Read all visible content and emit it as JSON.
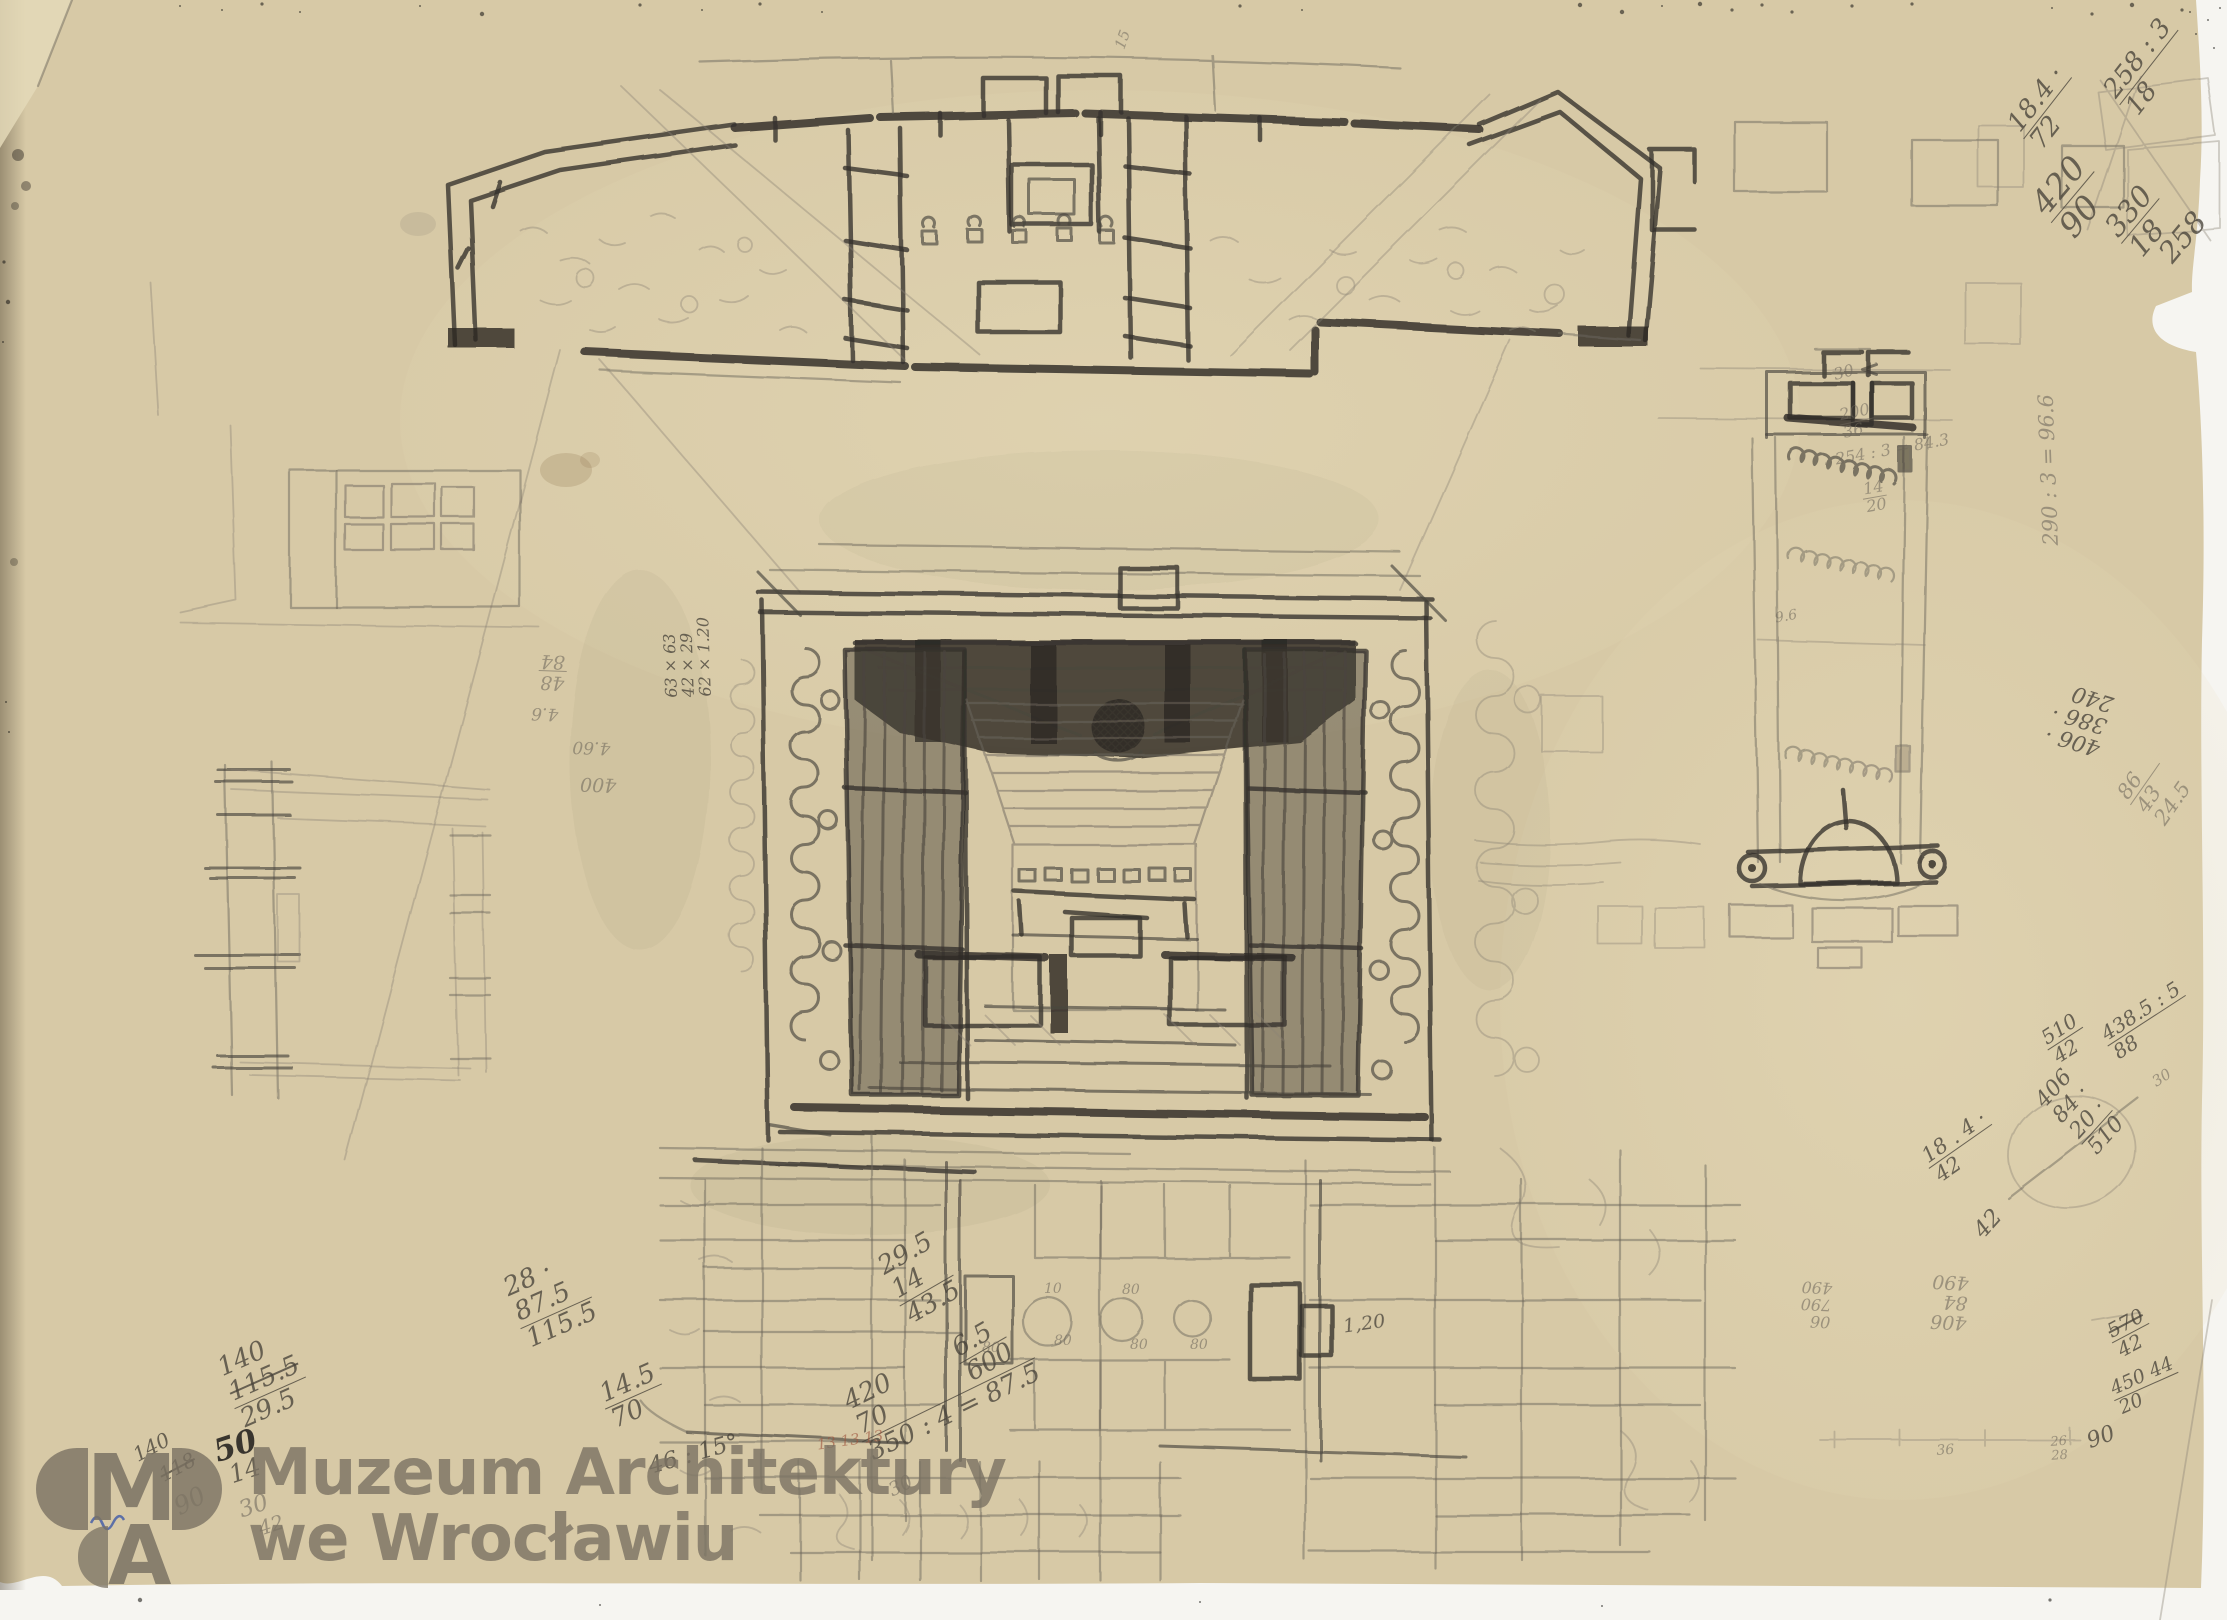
{
  "watermark": {
    "monogram_m": "M",
    "monogram_a": "A",
    "line1": "Muzeum Architektury",
    "line2": "we Wrocławiu"
  },
  "colors": {
    "paper": "#d7c9a6",
    "paper_light": "#e3d7b6",
    "paper_shadow": "#b9ab88",
    "backdrop": "#f6f5f1",
    "pencil_dark": "#2f2c28",
    "pencil_mid": "#5a544b",
    "pencil_light": "#8b8376",
    "red_pencil": "#9c543e",
    "logo_gray": "#7a7263",
    "blue_ink": "#3f5aa8"
  },
  "annotations": {
    "items": [
      {
        "t": [
          "18.4 ·",
          "72"
        ],
        "x": 2002,
        "y": 122,
        "r": -52,
        "s": 26,
        "c": "mid",
        "ul": 0
      },
      {
        "t": [
          "258 : 3",
          "18"
        ],
        "x": 2098,
        "y": 88,
        "r": -52,
        "s": 26,
        "c": "mid",
        "ul": 0
      },
      {
        "t": [
          "420",
          "90"
        ],
        "x": 2024,
        "y": 200,
        "r": -50,
        "s": 33,
        "c": "mid",
        "ul": 0
      },
      {
        "t": [
          "330",
          "18"
        ],
        "x": 2098,
        "y": 224,
        "r": -50,
        "s": 29,
        "c": "mid",
        "ul": 0
      },
      {
        "t": [
          "258"
        ],
        "x": 2152,
        "y": 250,
        "r": -50,
        "s": 29,
        "c": "mid"
      },
      {
        "t": [
          "30"
        ],
        "x": 1830,
        "y": 368,
        "r": -15,
        "s": 16,
        "c": "light"
      },
      {
        "t": [
          "200",
          "36"
        ],
        "x": 1836,
        "y": 408,
        "r": -12,
        "s": 16,
        "c": "light",
        "ul": 0
      },
      {
        "t": [
          "254 : 3 = 84.3"
        ],
        "x": 1832,
        "y": 452,
        "r": -10,
        "s": 16,
        "c": "light"
      },
      {
        "t": [
          "14",
          "20"
        ],
        "x": 1860,
        "y": 482,
        "r": -10,
        "s": 16,
        "c": "light",
        "ul": 0
      },
      {
        "t": [
          "290 : 3 = 96.6"
        ],
        "x": 2040,
        "y": 548,
        "r": -92,
        "s": 21,
        "c": "light"
      },
      {
        "t": [
          "9.6"
        ],
        "x": 1772,
        "y": 612,
        "r": -10,
        "s": 14,
        "c": "light"
      },
      {
        "t": [
          "406 ·",
          "386 ·",
          "240"
        ],
        "x": 2098,
        "y": 760,
        "r": 197,
        "s": 22,
        "c": "mid"
      },
      {
        "t": [
          "86",
          "43",
          "24.5"
        ],
        "x": 2112,
        "y": 792,
        "r": -55,
        "s": 21,
        "c": "light",
        "ul": 0
      },
      {
        "t": [
          "510",
          "42"
        ],
        "x": 2036,
        "y": 1032,
        "r": -33,
        "s": 20,
        "c": "mid",
        "ul": 0
      },
      {
        "t": [
          "438.5 : 5",
          "88"
        ],
        "x": 2096,
        "y": 1028,
        "r": -33,
        "s": 20,
        "c": "mid",
        "ul": 0
      },
      {
        "t": [
          "30"
        ],
        "x": 2148,
        "y": 1078,
        "r": -33,
        "s": 15,
        "c": "light"
      },
      {
        "t": [
          "406",
          "84 ·",
          "20 ·",
          "510"
        ],
        "x": 2030,
        "y": 1098,
        "r": -48,
        "s": 22,
        "c": "mid",
        "ul": 2
      },
      {
        "t": [
          "42"
        ],
        "x": 1968,
        "y": 1228,
        "r": -48,
        "s": 23,
        "c": "mid"
      },
      {
        "t": [
          "18 . 4 ·",
          "42"
        ],
        "x": 1916,
        "y": 1150,
        "r": -35,
        "s": 21,
        "c": "mid",
        "ul": 0
      },
      {
        "t": [
          "406",
          "84",
          "490"
        ],
        "x": 1968,
        "y": 1332,
        "r": 183,
        "s": 19,
        "c": "light"
      },
      {
        "t": [
          "06",
          "790",
          "490"
        ],
        "x": 1832,
        "y": 1330,
        "r": 183,
        "s": 16,
        "c": "light"
      },
      {
        "t": [
          "570",
          "42"
        ],
        "x": 2102,
        "y": 1324,
        "r": -28,
        "s": 20,
        "c": "mid",
        "ul": 0,
        "st": 0
      },
      {
        "t": [
          "450  44",
          "20"
        ],
        "x": 2106,
        "y": 1382,
        "r": -24,
        "s": 19,
        "c": "mid",
        "ul": 0
      },
      {
        "t": [
          "90"
        ],
        "x": 2082,
        "y": 1432,
        "r": -20,
        "s": 22,
        "c": "mid"
      },
      {
        "t": [
          "36"
        ],
        "x": 1934,
        "y": 1444,
        "r": -4,
        "s": 14,
        "c": "light"
      },
      {
        "t": [
          "26",
          "28"
        ],
        "x": 2048,
        "y": 1436,
        "r": -4,
        "s": 13,
        "c": "light"
      },
      {
        "t": [
          "63 × 63",
          "42 × 29",
          "62 × 1.20"
        ],
        "x": 664,
        "y": 700,
        "r": -92,
        "s": 16,
        "c": "mid"
      },
      {
        "t": [
          "48",
          "84"
        ],
        "x": 566,
        "y": 692,
        "r": 182,
        "s": 19,
        "c": "light",
        "ul": 0
      },
      {
        "t": [
          "4.6"
        ],
        "x": 560,
        "y": 722,
        "r": 182,
        "s": 17,
        "c": "light"
      },
      {
        "t": [
          "4.60"
        ],
        "x": 612,
        "y": 756,
        "r": 182,
        "s": 17,
        "c": "light"
      },
      {
        "t": [
          "400"
        ],
        "x": 618,
        "y": 794,
        "r": 182,
        "s": 19,
        "c": "light"
      },
      {
        "t": [
          "15"
        ],
        "x": 1112,
        "y": 48,
        "r": -70,
        "s": 15,
        "c": "light"
      },
      {
        "t": [
          "28 ·",
          "87.5",
          "115.5"
        ],
        "x": 498,
        "y": 1278,
        "r": -24,
        "s": 26,
        "c": "mid",
        "ul": 1
      },
      {
        "t": [
          "29.5",
          "14",
          "43.5"
        ],
        "x": 872,
        "y": 1258,
        "r": -30,
        "s": 26,
        "c": "mid",
        "ul": 1
      },
      {
        "t": [
          "6.5",
          "600"
        ],
        "x": 946,
        "y": 1340,
        "r": -30,
        "s": 26,
        "c": "mid",
        "ul": 0
      },
      {
        "t": [
          "140",
          "115.5",
          "29.5"
        ],
        "x": 212,
        "y": 1358,
        "r": -24,
        "s": 26,
        "c": "mid",
        "ul": 1,
        "st": 1
      },
      {
        "t": [
          "14.5",
          "70"
        ],
        "x": 594,
        "y": 1384,
        "r": -24,
        "s": 26,
        "c": "mid",
        "ul": 0
      },
      {
        "t": [
          "420",
          "70",
          "350 : 4 = 87.5"
        ],
        "x": 838,
        "y": 1392,
        "r": -26,
        "s": 26,
        "c": "mid",
        "ul": 1
      },
      {
        "t": [
          "30"
        ],
        "x": 884,
        "y": 1484,
        "r": -26,
        "s": 19,
        "c": "light"
      },
      {
        "t": [
          "46 : 15°"
        ],
        "x": 644,
        "y": 1456,
        "r": -16,
        "s": 23,
        "c": "mid"
      },
      {
        "t": [
          "13 13 13"
        ],
        "x": 814,
        "y": 1438,
        "r": -8,
        "s": 15,
        "c": "red"
      },
      {
        "t": [
          "140"
        ],
        "x": 128,
        "y": 1448,
        "r": -28,
        "s": 20,
        "c": "mid"
      },
      {
        "t": [
          "118"
        ],
        "x": 154,
        "y": 1468,
        "r": -28,
        "s": 20,
        "c": "mid",
        "st": 0
      },
      {
        "t": [
          "90"
        ],
        "x": 168,
        "y": 1498,
        "r": -28,
        "s": 25,
        "c": "light"
      },
      {
        "t": [
          "50"
        ],
        "x": 208,
        "y": 1438,
        "r": -18,
        "s": 31,
        "c": "dark"
      },
      {
        "t": [
          "14"
        ],
        "x": 224,
        "y": 1464,
        "r": -18,
        "s": 25,
        "c": "mid"
      },
      {
        "t": [
          "30"
        ],
        "x": 234,
        "y": 1500,
        "r": -18,
        "s": 23,
        "c": "light"
      },
      {
        "t": [
          "42"
        ],
        "x": 254,
        "y": 1520,
        "r": -18,
        "s": 20,
        "c": "light"
      },
      {
        "t": [
          "10"
        ],
        "x": 1042,
        "y": 1282,
        "r": 0,
        "s": 14,
        "c": "light"
      },
      {
        "t": [
          "80"
        ],
        "x": 1120,
        "y": 1283,
        "r": 0,
        "s": 14,
        "c": "light"
      },
      {
        "t": [
          "80"
        ],
        "x": 1052,
        "y": 1334,
        "r": 0,
        "s": 14,
        "c": "light"
      },
      {
        "t": [
          "80"
        ],
        "x": 1128,
        "y": 1338,
        "r": 0,
        "s": 14,
        "c": "light"
      },
      {
        "t": [
          "80"
        ],
        "x": 1188,
        "y": 1338,
        "r": 0,
        "s": 14,
        "c": "light"
      },
      {
        "t": [
          "80"
        ],
        "x": 980,
        "y": 1341,
        "r": 0,
        "s": 14,
        "c": "light"
      },
      {
        "t": [
          "1,20"
        ],
        "x": 1340,
        "y": 1318,
        "r": -8,
        "s": 19,
        "c": "mid"
      }
    ]
  }
}
